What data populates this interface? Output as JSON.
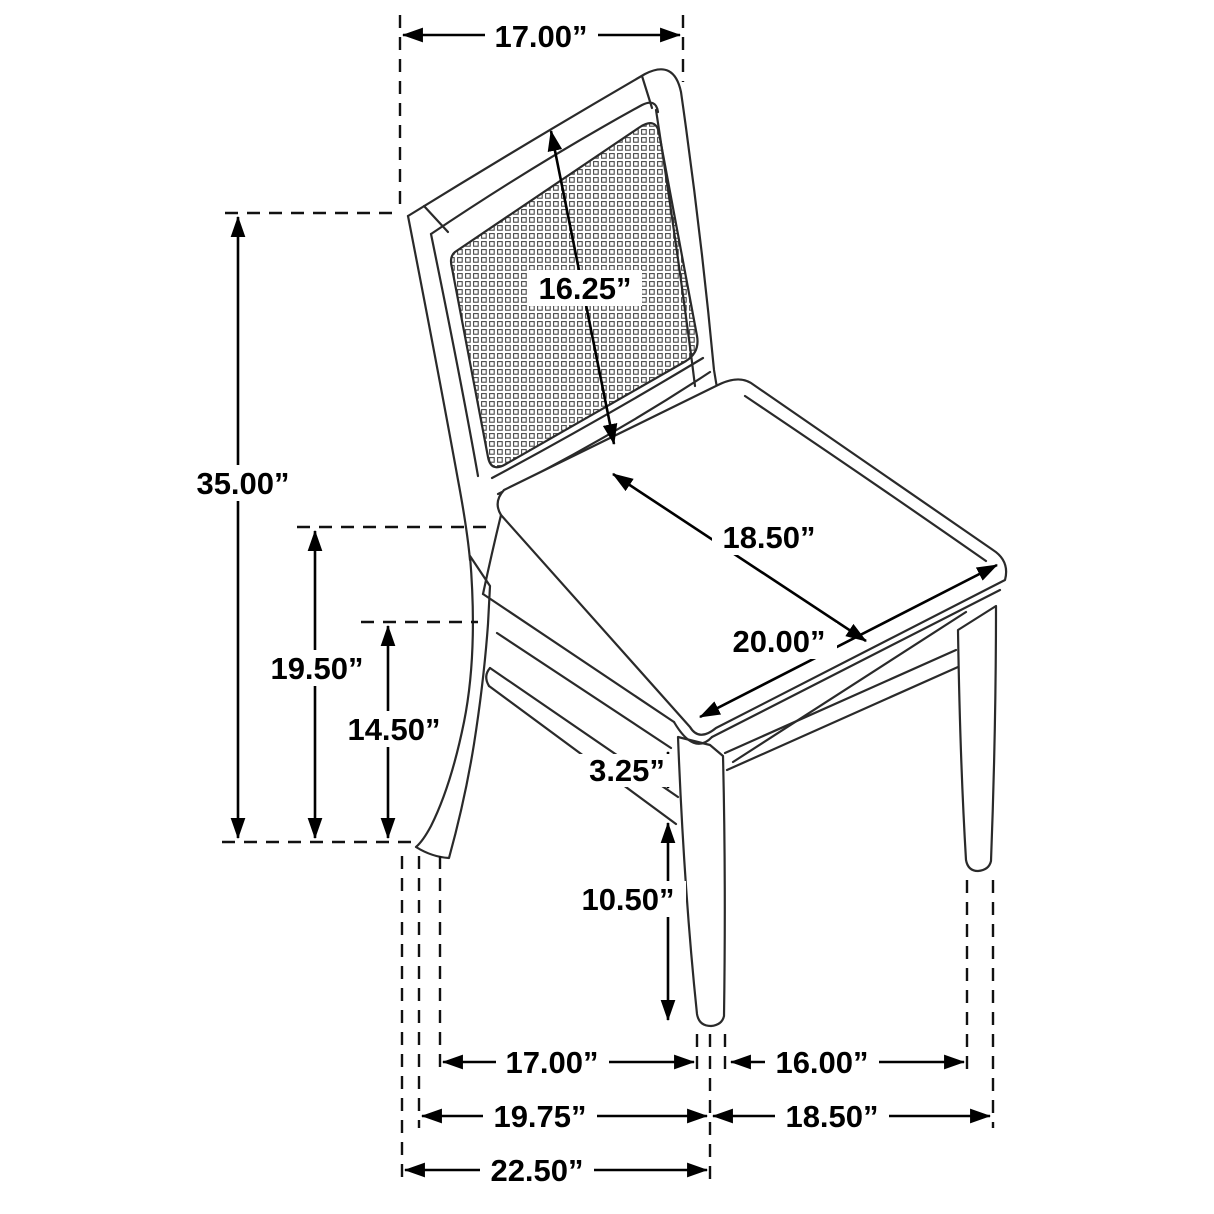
{
  "diagram": {
    "subject": "dining side chair with cane back - dimension drawing",
    "line_color": "#2a2a2a",
    "dimension_color": "#000000",
    "background": "#ffffff"
  },
  "dimensions": {
    "back_width_top": "17.00”",
    "backrest_diagonal": "16.25”",
    "overall_height": "35.00”",
    "floor_to_seat_back": "19.50”",
    "floor_to_apron": "14.50”",
    "seat_depth": "18.50”",
    "seat_width": "20.00”",
    "apron_to_stretcher_gap": "3.25”",
    "stretcher_floor_clearance": "10.50”",
    "front_leg_spacing": "17.00”",
    "side_leg_spacing": "16.00”",
    "base_width_left": "19.75”",
    "base_depth_right": "18.50”",
    "overall_base_width": "22.50”"
  }
}
